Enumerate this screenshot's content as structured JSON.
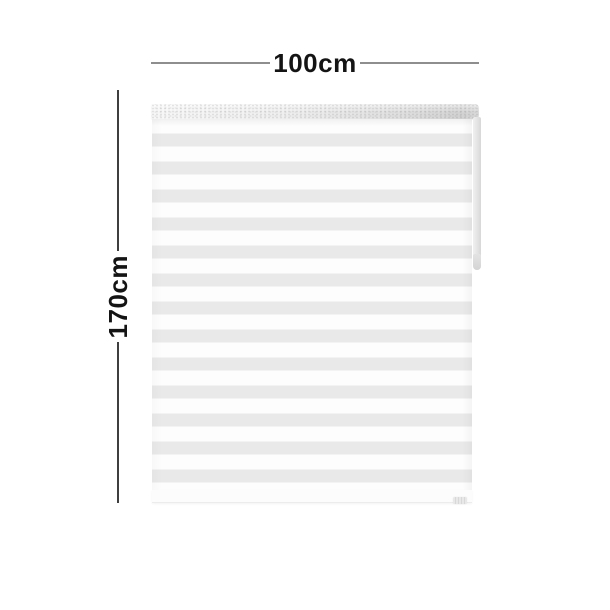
{
  "diagram": {
    "width_label": "100cm",
    "height_label": "170cm"
  },
  "theme": {
    "stripe-gray": "#e9e9e9",
    "stripe-white": "#fdfdfd",
    "h-line": "#8e8e8e",
    "v-line": "#3f3f3f",
    "label-color": "#141414",
    "rail-gray": "#d2d2d2",
    "chain-gray": "#e2e2e2",
    "page-bg": "#ffffff"
  }
}
